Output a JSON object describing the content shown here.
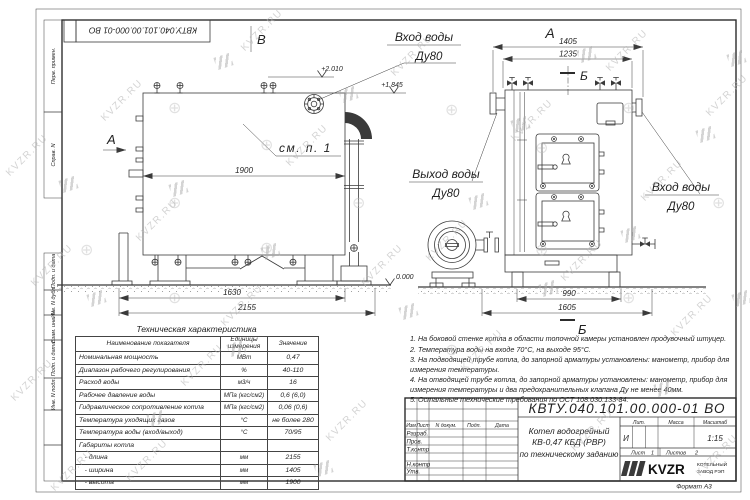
{
  "watermark": {
    "text": "KVZR.RU",
    "stamp": "⊕"
  },
  "stamp_top": {
    "doc_number": "КВТУ.040.101.00.000-01  ВО"
  },
  "frame": {
    "left_labels": [
      "Перв. примен.",
      "Справ. N",
      "Подп. и дата",
      "Инв. N дубл.",
      "Взам. инв. N",
      "Подп. и дата",
      "Инв. N подл."
    ]
  },
  "views": {
    "left": {
      "view_top": "В",
      "view_side": "А",
      "callout": "см. п. 1",
      "inlet": "Вход воды",
      "inlet_dn": "Ду80",
      "elev_top": "+2.010",
      "elev_mid": "+1.845",
      "elev_zero": "0.000",
      "dim_inner": "1900",
      "dim_base": "1630",
      "dim_total": "2155"
    },
    "right": {
      "view": "А",
      "section_top": "Б",
      "section_bottom": "Б",
      "outlet": "Выход воды",
      "outlet_dn": "Ду80",
      "inlet": "Вход воды",
      "inlet_dn": "Ду80",
      "dim_width": "1405",
      "dim_inner": "1235",
      "dim_base": "990",
      "dim_total": "1605"
    }
  },
  "spec_table": {
    "title": "Техническая характеристика",
    "headers": [
      "Наименование показателя",
      "Единицы измерения",
      "Значение"
    ],
    "rows": [
      [
        "Номинальная мощность",
        "МВт",
        "0,47"
      ],
      [
        "Диапазон рабочего регулирования",
        "%",
        "40-110"
      ],
      [
        "Расход воды",
        "м3/ч",
        "16"
      ],
      [
        "Рабочее давление воды",
        "МПа (кгс/см2)",
        "0,6 (6,0)"
      ],
      [
        "Гидравлическое сопротивление котла",
        "МПа (кгс/см2)",
        "0,06 (0,6)"
      ],
      [
        "Температура уходящих газов",
        "°С",
        "не более 280"
      ],
      [
        "Температура воды (вход/выход)",
        "°С",
        "70/95"
      ],
      [
        "Габариты котла",
        "",
        ""
      ],
      [
        "   - длина",
        "мм",
        "2155"
      ],
      [
        "   - ширина",
        "мм",
        "1405"
      ],
      [
        "   - высота",
        "мм",
        "1900"
      ]
    ]
  },
  "notes": [
    "1.  На боковой стенке котла в области топочной камеры установлен продувочный штуцер.",
    "2.  Температура воды на входе 70°С, на выходе 95°С.",
    "3.  На подводящей трубе котла, до запорной арматуры установлены: манометр, прибор для измерения температуры.",
    "4.  На отводящей трубе котла, до запорной арматуры установлены: манометр, прибор для измерения температуры и два предохранительных клапана Ду не менее 40мм.",
    "5.  Остальные технические требования по ОСТ 108.030.133-84."
  ],
  "title_block": {
    "doc_number": "КВТУ.040.101.00.000-01  ВО",
    "cols": [
      "Изм",
      "Лист",
      "N докум.",
      "Подп.",
      "Дата"
    ],
    "rows": [
      "Разраб.",
      "Пров.",
      "Т.контр",
      "Н.контр",
      "Утв."
    ],
    "title1": "Котел водогрейный",
    "title2": "КВ-0,47 КБД (РВР)",
    "title3": "по техническому заданию",
    "lit_h": "Лит.",
    "mass_h": "Масса",
    "scale_h": "Масштаб",
    "lit": "И",
    "scale": "1:15",
    "sheet_h": "Лист",
    "sheet": "1",
    "sheets_h": "Листов",
    "sheets": "2",
    "logo": "KVZR",
    "company1": "КОТЕЛЬНЫЙ",
    "company2": "ЗАВОД РЭП",
    "format": "Формат  А3"
  }
}
